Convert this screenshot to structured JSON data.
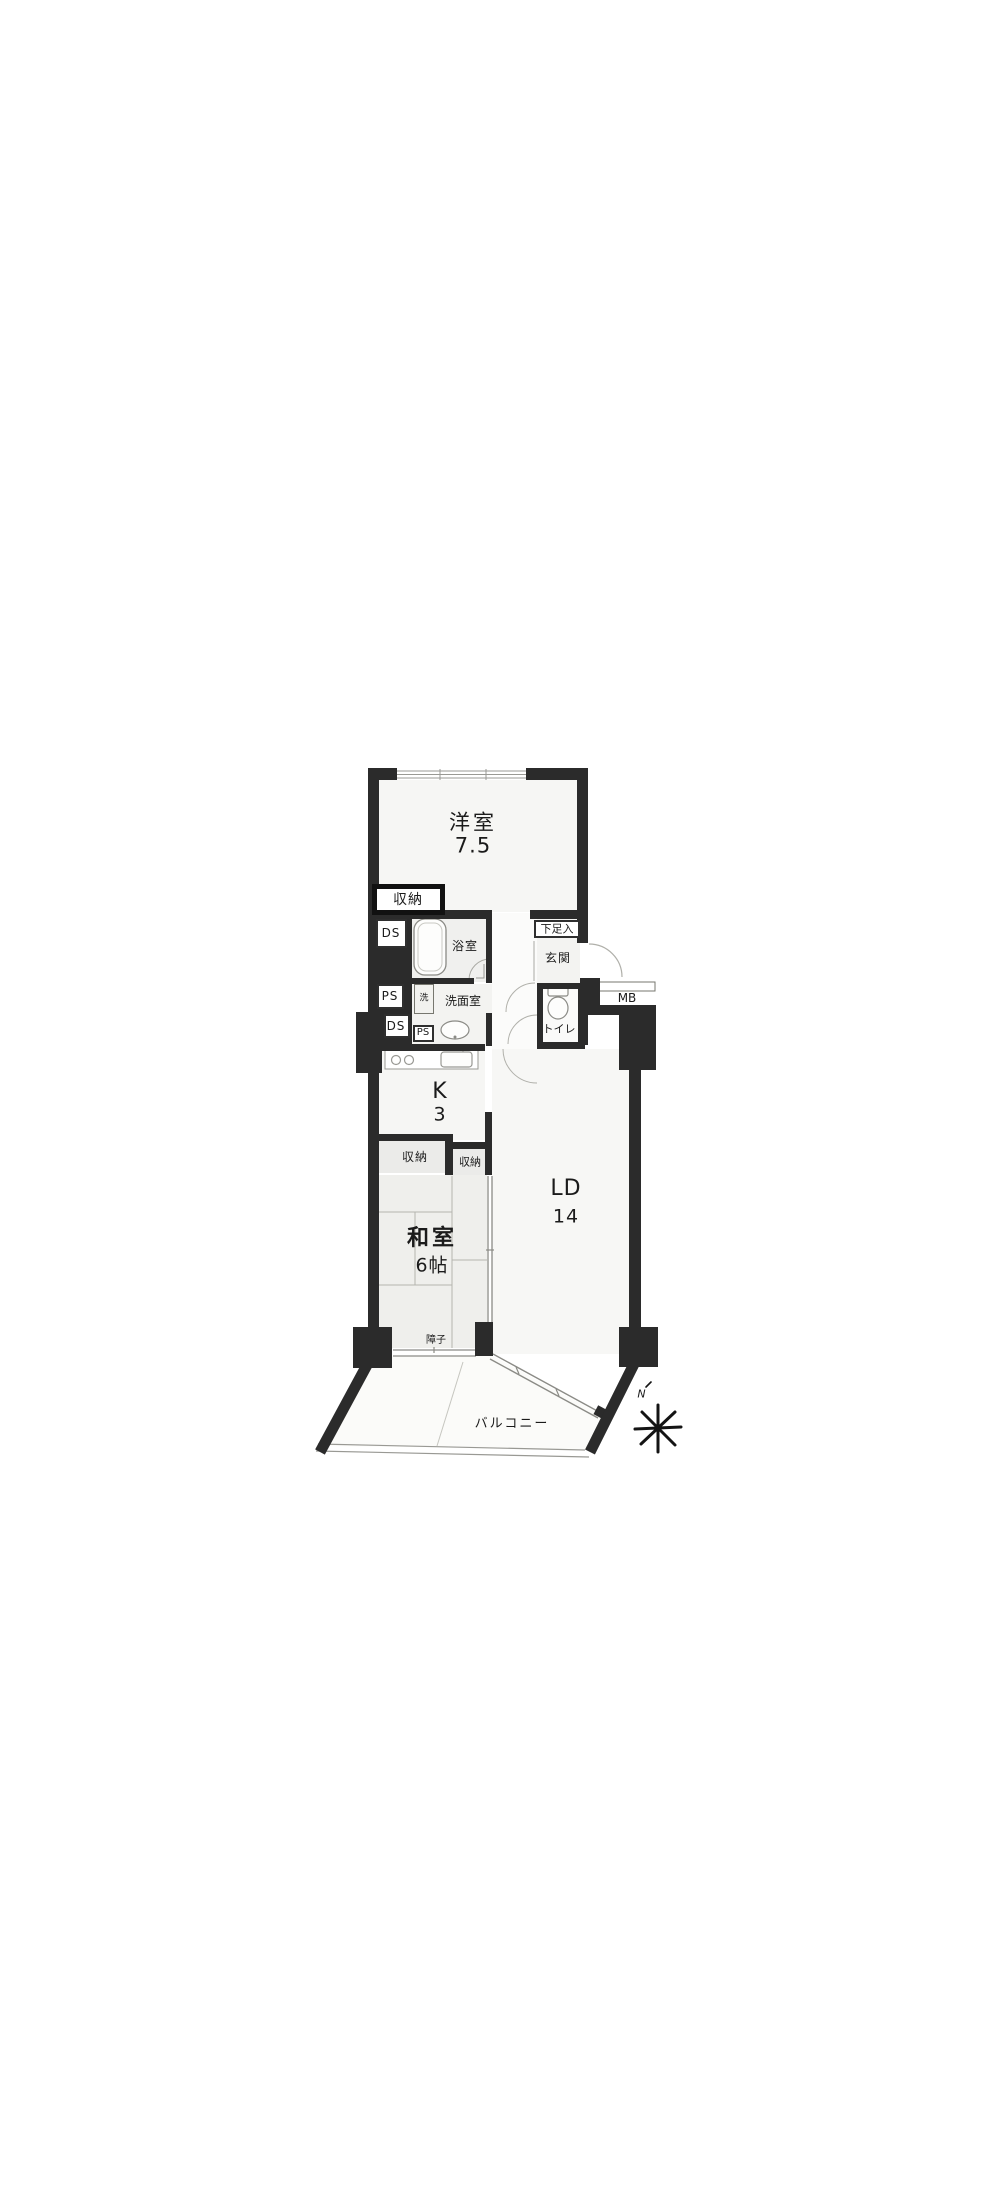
{
  "document": {
    "kind": "apartment-floorplan"
  },
  "colors": {
    "wall": "#2b2b2b",
    "thin_line": "#999994",
    "tatami_fill": "#efefec",
    "room_fill": "#f5f5f3",
    "text": "#1b1b1b"
  },
  "rooms": {
    "western_room": {
      "name": "洋室",
      "size": "7.5"
    },
    "kitchen": {
      "name": "K",
      "size": "3"
    },
    "japanese_room": {
      "name": "和室",
      "size": "6帖"
    },
    "living_dining": {
      "name": "LD",
      "size": "14"
    }
  },
  "labels": {
    "closet_main": "収納",
    "duct_upper": "DS",
    "pipe_upper": "PS",
    "duct_lower": "DS",
    "pipe_lower": "PS",
    "bath": "浴室",
    "laundry": "洗",
    "washroom": "洗面室",
    "toilet": "トイレ",
    "shoe_cabinet": "下足入",
    "entrance": "玄関",
    "meter_box": "MB",
    "closet_left": "収納",
    "closet_right": "収納",
    "shoji": "障子",
    "balcony": "バルコニー",
    "compass_north": "N"
  }
}
